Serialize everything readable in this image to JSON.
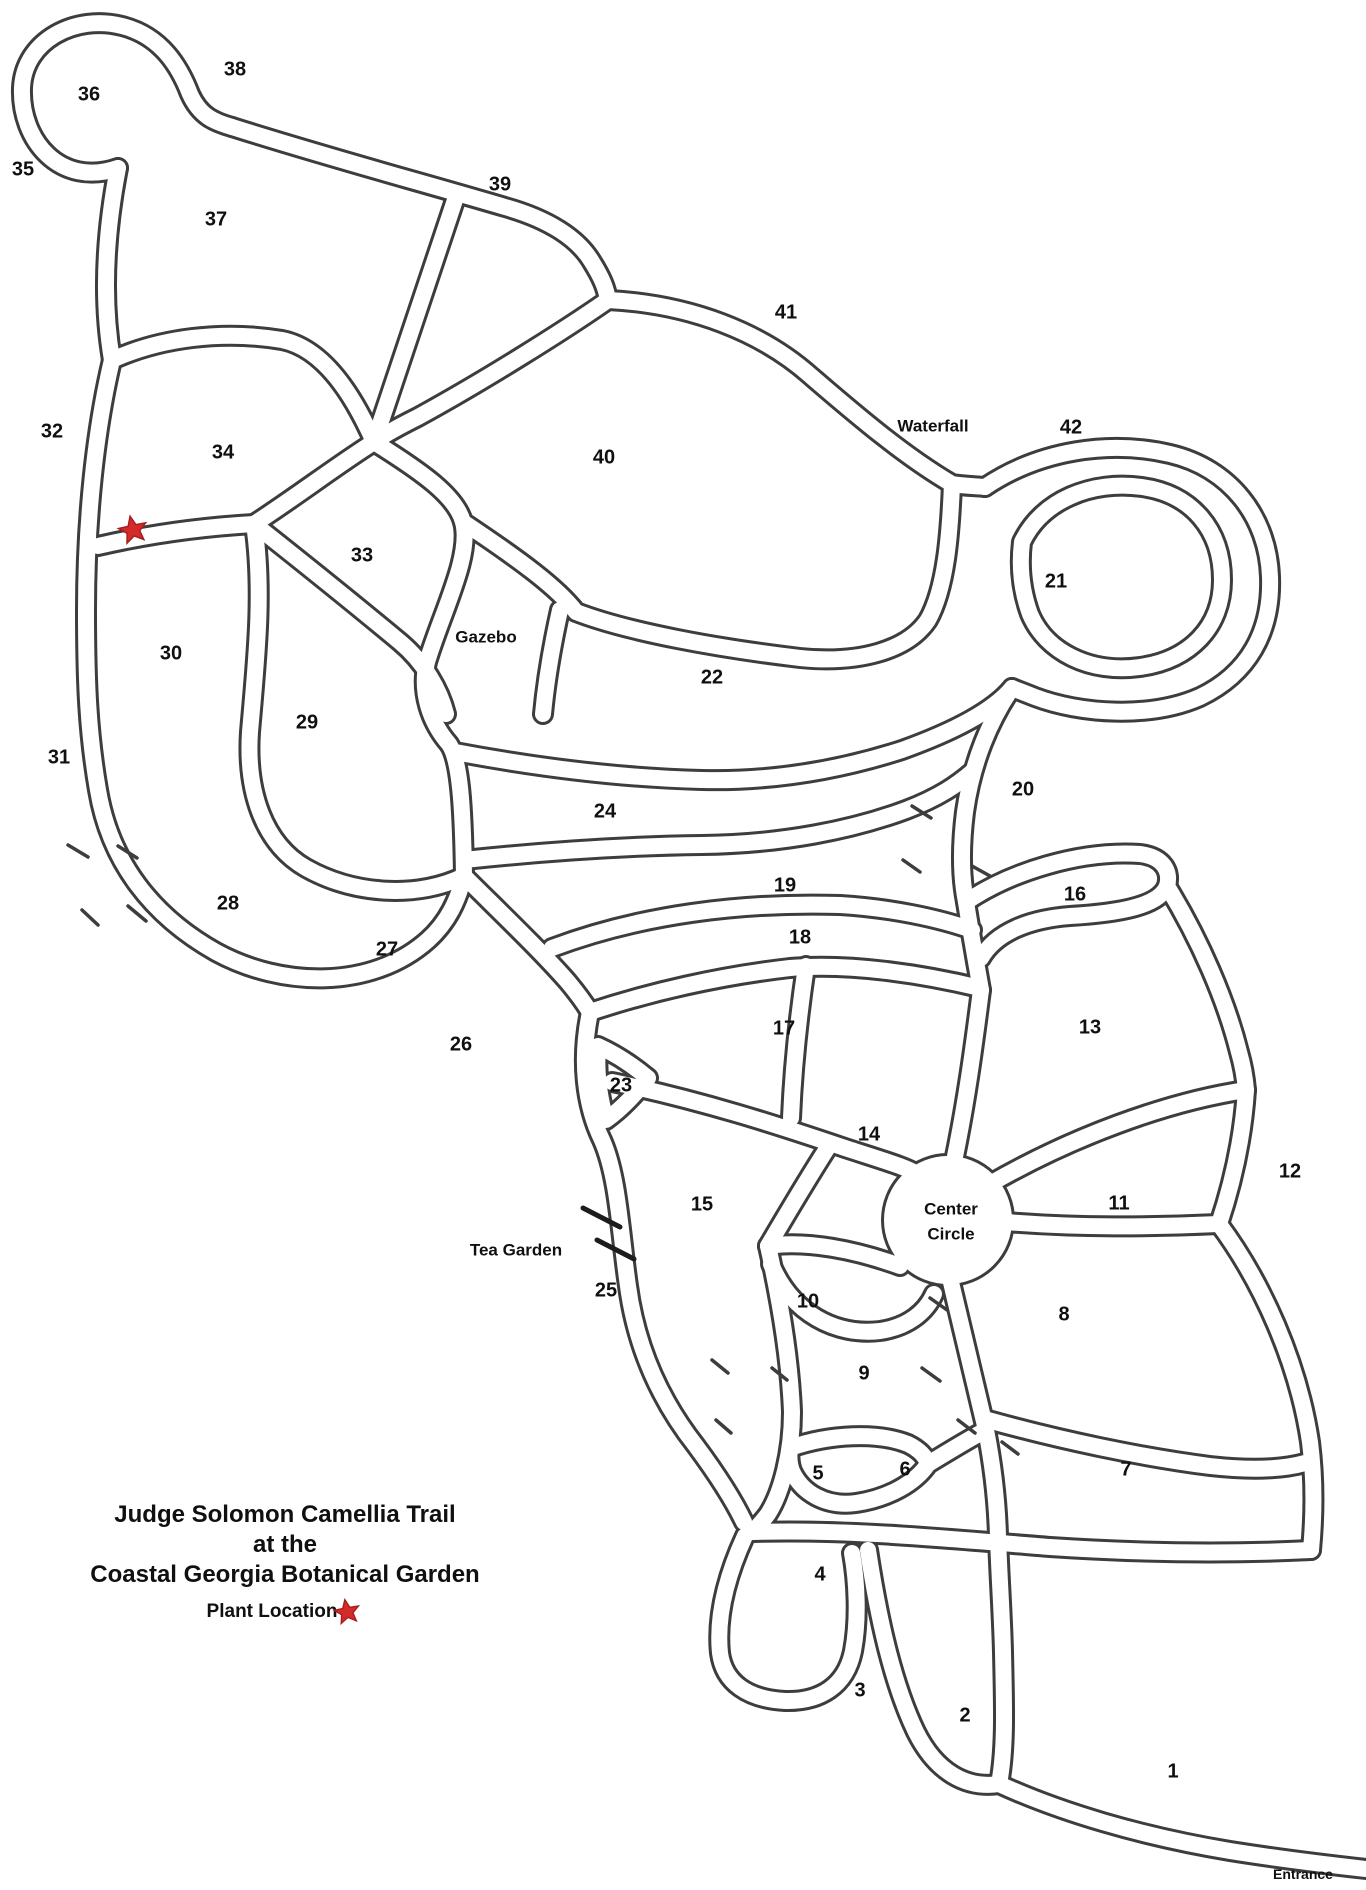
{
  "title": {
    "line1": "Judge Solomon Camellia Trail",
    "line2": "at the",
    "line3": "Coastal Georgia Botanical Garden"
  },
  "legend": {
    "plant_location_label": "Plant Location",
    "star_icon": "red-star"
  },
  "colors": {
    "line": "#3d3d3d",
    "text": "#101010",
    "star": "#d42a2a",
    "background": "#ffffff"
  },
  "map": {
    "plant_marker": {
      "x": 133,
      "y": 530
    },
    "regions": [
      {
        "n": "1",
        "x": 1173,
        "y": 1772
      },
      {
        "n": "2",
        "x": 965,
        "y": 1716
      },
      {
        "n": "3",
        "x": 860,
        "y": 1691
      },
      {
        "n": "4",
        "x": 820,
        "y": 1575
      },
      {
        "n": "5",
        "x": 818,
        "y": 1474
      },
      {
        "n": "6",
        "x": 905,
        "y": 1470
      },
      {
        "n": "7",
        "x": 1126,
        "y": 1470
      },
      {
        "n": "8",
        "x": 1064,
        "y": 1315
      },
      {
        "n": "9",
        "x": 864,
        "y": 1374
      },
      {
        "n": "10",
        "x": 808,
        "y": 1302
      },
      {
        "n": "11",
        "x": 1119,
        "y": 1204
      },
      {
        "n": "12",
        "x": 1290,
        "y": 1172
      },
      {
        "n": "13",
        "x": 1090,
        "y": 1028
      },
      {
        "n": "14",
        "x": 869,
        "y": 1135
      },
      {
        "n": "15",
        "x": 702,
        "y": 1205
      },
      {
        "n": "16",
        "x": 1075,
        "y": 895
      },
      {
        "n": "17",
        "x": 784,
        "y": 1029
      },
      {
        "n": "18",
        "x": 800,
        "y": 938
      },
      {
        "n": "19",
        "x": 785,
        "y": 886
      },
      {
        "n": "20",
        "x": 1023,
        "y": 790
      },
      {
        "n": "21",
        "x": 1056,
        "y": 582
      },
      {
        "n": "22",
        "x": 712,
        "y": 678
      },
      {
        "n": "23",
        "x": 621,
        "y": 1086
      },
      {
        "n": "24",
        "x": 605,
        "y": 812
      },
      {
        "n": "25",
        "x": 606,
        "y": 1291
      },
      {
        "n": "26",
        "x": 461,
        "y": 1045
      },
      {
        "n": "27",
        "x": 387,
        "y": 950
      },
      {
        "n": "28",
        "x": 228,
        "y": 904
      },
      {
        "n": "29",
        "x": 307,
        "y": 723
      },
      {
        "n": "30",
        "x": 171,
        "y": 654
      },
      {
        "n": "31",
        "x": 59,
        "y": 758
      },
      {
        "n": "32",
        "x": 52,
        "y": 432
      },
      {
        "n": "33",
        "x": 362,
        "y": 556
      },
      {
        "n": "34",
        "x": 223,
        "y": 453
      },
      {
        "n": "35",
        "x": 23,
        "y": 170
      },
      {
        "n": "36",
        "x": 89,
        "y": 95
      },
      {
        "n": "37",
        "x": 216,
        "y": 220
      },
      {
        "n": "38",
        "x": 235,
        "y": 70
      },
      {
        "n": "39",
        "x": 500,
        "y": 185
      },
      {
        "n": "40",
        "x": 604,
        "y": 458
      },
      {
        "n": "41",
        "x": 786,
        "y": 313
      },
      {
        "n": "42",
        "x": 1071,
        "y": 428
      }
    ],
    "pois": [
      {
        "id": "waterfall",
        "text": "Waterfall",
        "x": 933,
        "y": 427,
        "size": "normal"
      },
      {
        "id": "gazebo",
        "text": "Gazebo",
        "x": 486,
        "y": 638,
        "size": "normal"
      },
      {
        "id": "center-circle",
        "text": "Center\nCircle",
        "x": 951,
        "y": 1222,
        "size": "normal"
      },
      {
        "id": "tea-garden",
        "text": "Tea Garden",
        "x": 516,
        "y": 1251,
        "size": "normal"
      },
      {
        "id": "entrance",
        "text": "Entrance",
        "x": 1303,
        "y": 1874,
        "size": "small"
      }
    ]
  }
}
